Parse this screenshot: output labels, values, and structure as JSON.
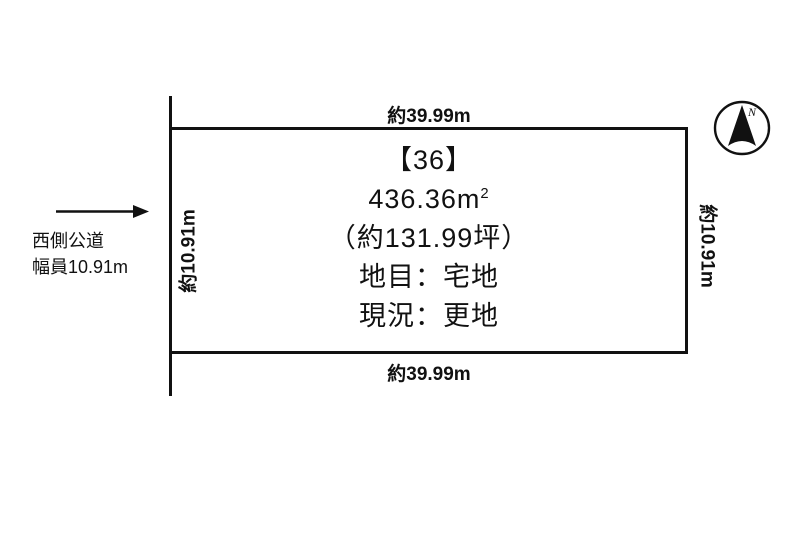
{
  "page": {
    "background": "#ffffff",
    "line_color": "#111111"
  },
  "plot": {
    "id_label": "【36】",
    "area_value": "436.36",
    "area_unit": "m",
    "area_sup": "2",
    "area_tsubo": "（約131.99坪）",
    "land_category": "地目：宅地",
    "current_status": "現況：更地"
  },
  "dimensions": {
    "top": "約39.99m",
    "bottom": "約39.99m",
    "left": "約10.91m",
    "right": "約10.91m"
  },
  "road": {
    "name": "西側公道",
    "width": "幅員10.91m"
  },
  "compass": {
    "label": "N"
  }
}
